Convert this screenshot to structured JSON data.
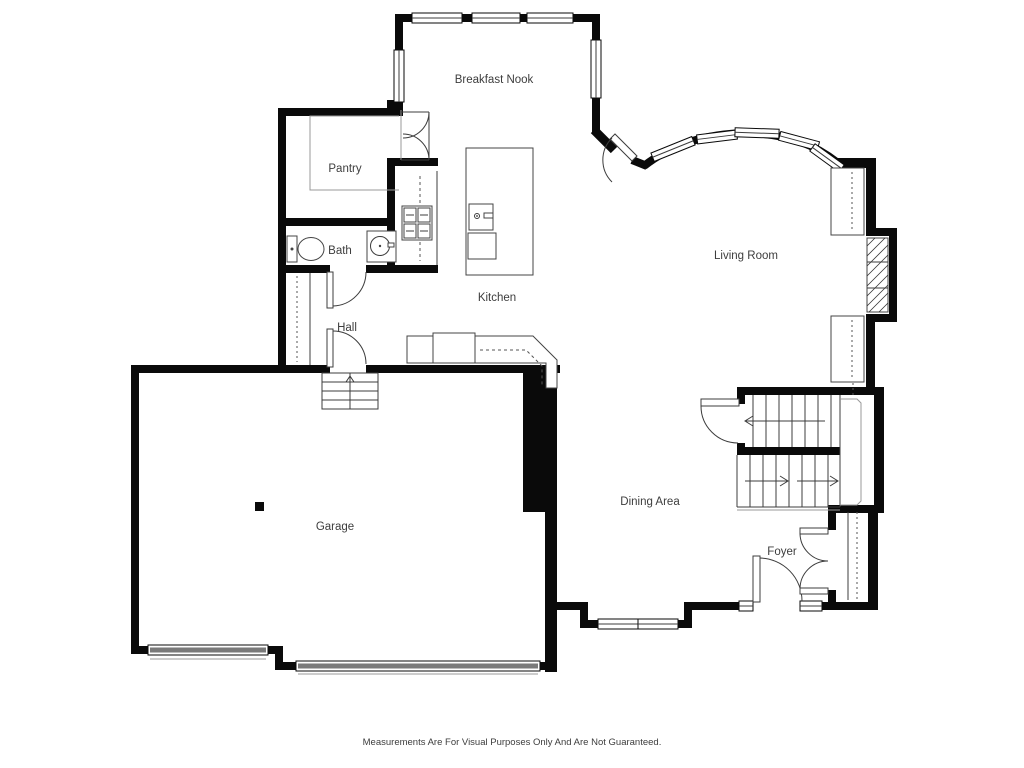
{
  "floorplan": {
    "rooms": [
      {
        "id": "breakfast-nook",
        "label": "Breakfast Nook"
      },
      {
        "id": "pantry",
        "label": "Pantry"
      },
      {
        "id": "bath",
        "label": "Bath"
      },
      {
        "id": "kitchen",
        "label": "Kitchen"
      },
      {
        "id": "hall",
        "label": "Hall"
      },
      {
        "id": "living-room",
        "label": "Living Room"
      },
      {
        "id": "garage",
        "label": "Garage"
      },
      {
        "id": "dining-area",
        "label": "Dining Area"
      },
      {
        "id": "foyer",
        "label": "Foyer"
      }
    ],
    "disclaimer": "Measurements Are For Visual Purposes Only And Are Not Guaranteed.",
    "colors": {
      "wall": "#0a0a0a",
      "thin_line": "#3c3c3c",
      "light_line": "#999999",
      "garage_door": "#7a7a7a",
      "label_text": "#3d3d3d",
      "background": "#ffffff"
    }
  }
}
